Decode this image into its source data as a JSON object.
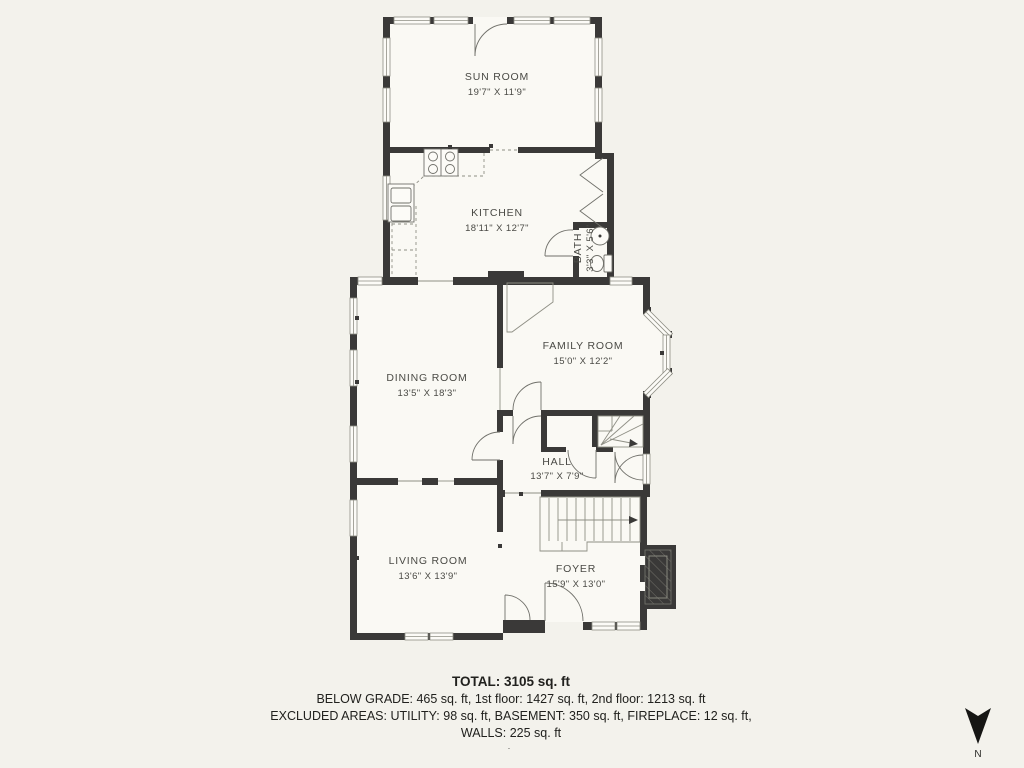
{
  "colors": {
    "background": "#f3f2ec",
    "floor": "#faf9f4",
    "wall": "#3a3938",
    "window_line": "#8f8f85",
    "door_line": "#70706a",
    "label_text": "#4a4a45",
    "footer_text": "#21211e"
  },
  "rooms": [
    {
      "id": "sun-room",
      "name": "SUN ROOM",
      "dims": "19'7\" X 11'9\""
    },
    {
      "id": "kitchen",
      "name": "KITCHEN",
      "dims": "18'11\" X 12'7\""
    },
    {
      "id": "bath",
      "name": "BATH",
      "dims": "3'3\" X 5'6\""
    },
    {
      "id": "dining-room",
      "name": "DINING ROOM",
      "dims": "13'5\" X 18'3\""
    },
    {
      "id": "family-room",
      "name": "FAMILY ROOM",
      "dims": "15'0\" X 12'2\""
    },
    {
      "id": "hall",
      "name": "HALL",
      "dims": "13'7\" X 7'9\""
    },
    {
      "id": "living-room",
      "name": "LIVING ROOM",
      "dims": "13'6\" X 13'9\""
    },
    {
      "id": "foyer",
      "name": "FOYER",
      "dims": "15'9\" X 13'0\""
    }
  ],
  "footer": {
    "total": "TOTAL: 3105 sq. ft",
    "line1": "BELOW GRADE: 465 sq. ft, 1st floor: 1427 sq. ft, 2nd floor: 1213 sq. ft",
    "line2": "EXCLUDED AREAS: UTILITY: 98 sq. ft, BASEMENT: 350 sq. ft, FIREPLACE: 12 sq. ft,",
    "line3": "WALLS: 225 sq. ft",
    "dot": "."
  },
  "compass": {
    "label": "N"
  }
}
